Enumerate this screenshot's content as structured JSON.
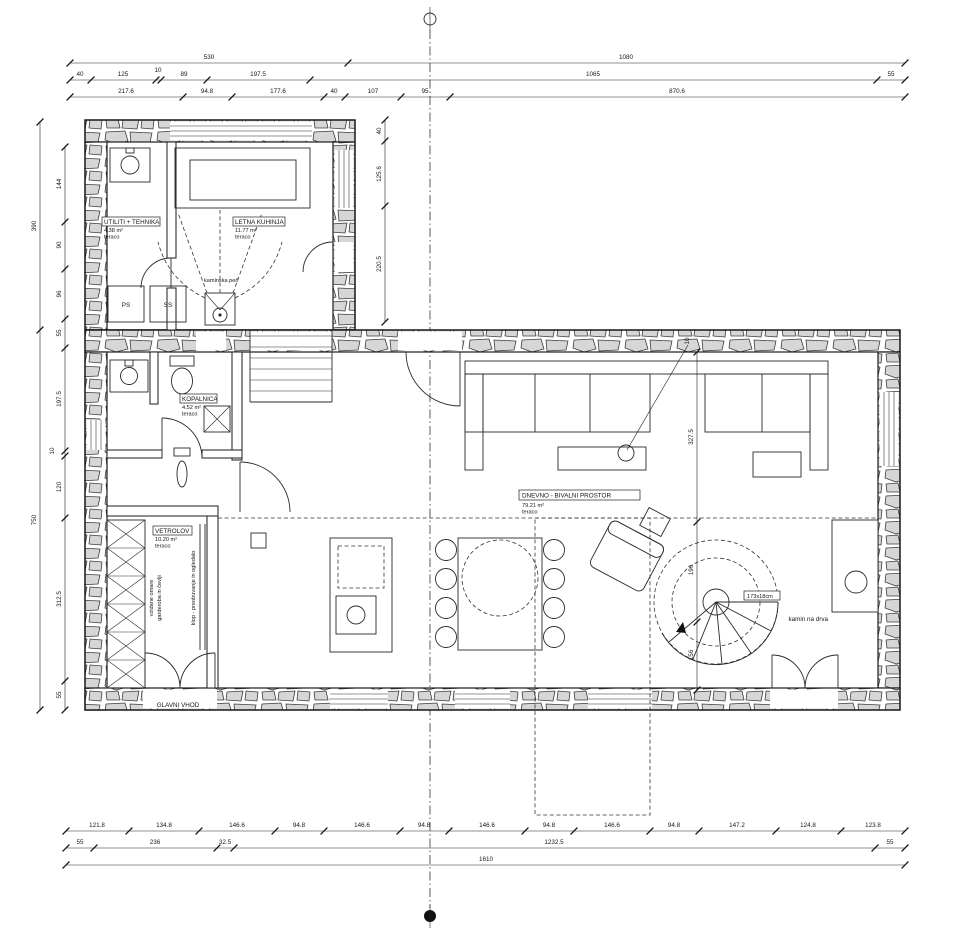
{
  "drawing": {
    "kind": "floor-plan",
    "entrance_label": "GLAVNI VHOD"
  },
  "rooms": {
    "utiliti": {
      "name": "UTILITI + TEHNIKA",
      "area": "4.38 m²",
      "floor": "teraco"
    },
    "kuhinja": {
      "name": "LETNA KUHINJA",
      "area": "11.77 m²",
      "floor": "teraco"
    },
    "kopalnica": {
      "name": "KOPALNICA",
      "area": "4.52 m²",
      "floor": "teraco"
    },
    "vetrolov": {
      "name": "VETROLOV",
      "area": "10.20 m²",
      "floor": "teraco"
    },
    "dnevno": {
      "name": "DNEVNO - BIVALNI PROSTOR",
      "area": "79.21 m²",
      "floor": "teraco"
    }
  },
  "labels": {
    "kaminska_pec": "kaminska peč",
    "kamin_na_drva": "kamin na drva",
    "glavni_vhod": "GLAVNI VHOD",
    "spiral": "173x18cm",
    "ps": "PS",
    "ss": "SS",
    "wardrobe1": "vzidane omare",
    "wardrobe2": "garderoba in čevlji",
    "klop": "klop - preobuvanje in ogledalo"
  },
  "dims": {
    "top1": [
      "530",
      "1080"
    ],
    "top2": [
      "40",
      "125",
      "10",
      "89",
      "197.5",
      "1065",
      "55"
    ],
    "top3": [
      "217.6",
      "94.8",
      "177.6",
      "40",
      "107",
      "95",
      "870.6"
    ],
    "left_outer": [
      "390",
      "750"
    ],
    "left_inner": [
      "144",
      "90",
      "96",
      "55",
      "197.5",
      "10",
      "120",
      "312.5",
      "55"
    ],
    "wing": [
      "40",
      "125.6",
      "220.5"
    ],
    "right": [
      "10",
      "327.5",
      "196",
      "156"
    ],
    "bot1": [
      "121.8",
      "134.8",
      "146.6",
      "94.8",
      "146.6",
      "94.8",
      "146.6",
      "94.8",
      "146.6",
      "94.8",
      "147.2",
      "124.8",
      "123.8"
    ],
    "bot2": [
      "55",
      "236",
      "32.5",
      "1232.5",
      "55"
    ],
    "bot3": [
      "1610"
    ]
  },
  "colors": {
    "stone_fill": "#d6d6d6",
    "line": "#1b1b1b",
    "background": "#ffffff"
  }
}
